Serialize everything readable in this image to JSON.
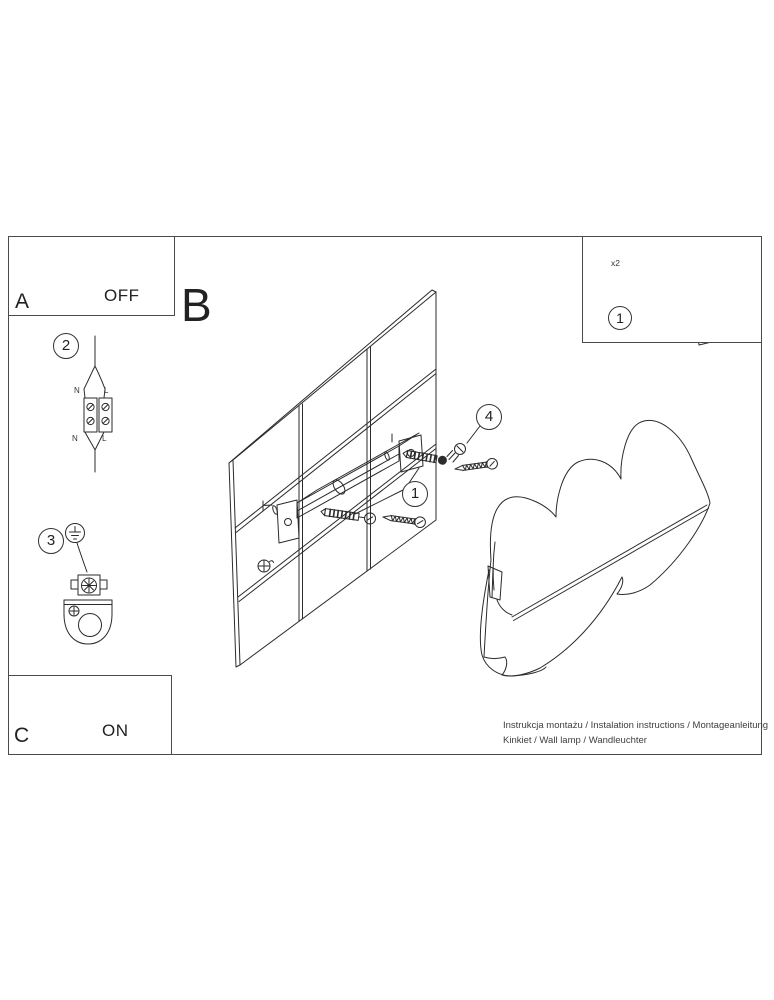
{
  "title": {
    "section_letter": "B"
  },
  "panels": {
    "a": {
      "label": "A",
      "action": "OFF"
    },
    "c": {
      "label": "C",
      "action": "ON"
    },
    "parts": {
      "callout": "1",
      "anchor_qty": "x2"
    }
  },
  "steps": {
    "wire_connector": "2",
    "ground_terminal": "3"
  },
  "callouts": {
    "wall_anchor": "1",
    "lamp_screw": "4"
  },
  "terminal_labels": {
    "top_n": "N",
    "top_l": "L",
    "bottom_n": "N",
    "bottom_l": "L"
  },
  "footer": {
    "line1": "Instrukcja montażu / Instalation instructions / Montageanleitung",
    "line2": "Kinkiet / Wall lamp / Wandleuchter"
  },
  "colors": {
    "line": "#2b2b2b",
    "background": "#ffffff",
    "border": "#4a4a4a"
  }
}
